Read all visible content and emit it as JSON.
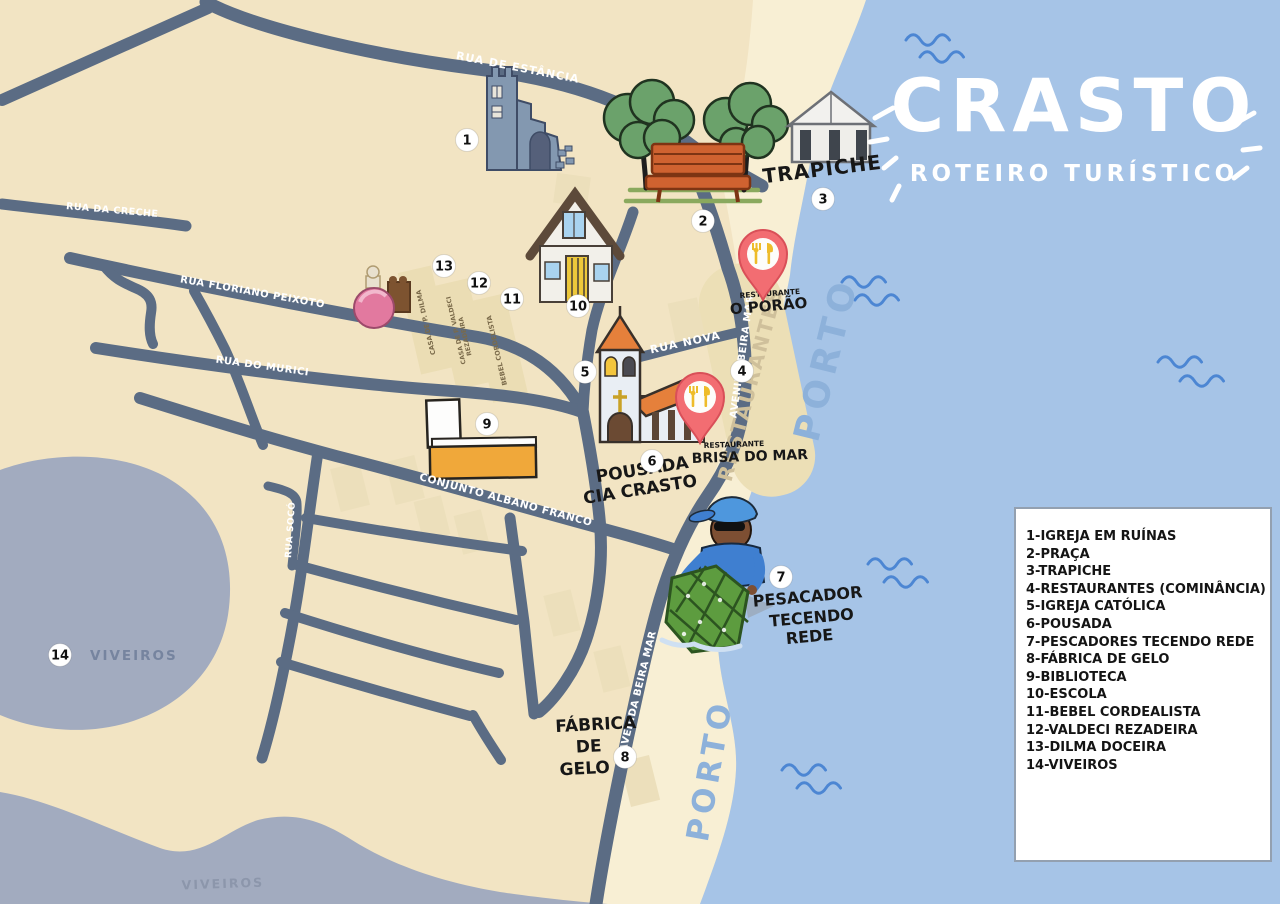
{
  "title": {
    "main": "CRASTO",
    "subtitle": "ROTEIRO TURÍSTICO"
  },
  "legend": {
    "items": [
      "1-IGREJA EM RUÍNAS",
      "2-PRAÇA",
      "3-TRAPICHE",
      "4-RESTAURANTES (COMINÂNCIA)",
      "5-IGREJA CATÓLICA",
      "6-POUSADA",
      "7-PESCADORES TECENDO REDE",
      "8-FÁBRICA DE GELO",
      "9-BIBLIOTECA",
      "10-ESCOLA",
      "11-BEBEL CORDEALISTA",
      "12-VALDECI REZADEIRA",
      "13-DILMA DOCEIRA",
      "14-VIVEIROS"
    ]
  },
  "streets": {
    "estancia": "RUA DE ESTÂNCIA",
    "creche": "RUA DA CRECHE",
    "floriano": "RUA FLORIANO PEIXOTO",
    "murici": "RUA DO MURICI",
    "nova": "RUA NOVA",
    "beira_mar": "AVENIDA BEIRA MAR",
    "conjunto": "CONJUNTO ALBANO FRANCO",
    "soco": "RUA SOCÓ"
  },
  "places": {
    "trapiche": "TRAPICHE",
    "restaurante_label": "RESTAURANTE",
    "porao": "O PORÃO",
    "brisa": "BRISA DO MAR",
    "pousada1": "POUSADA",
    "pousada2": "CIA CRASTO",
    "pescador1": "PESACADOR",
    "pescador2": "TECENDO",
    "pescador3": "REDE",
    "fabrica1": "FÁBRICA",
    "fabrica2": "DE",
    "fabrica3": "GELO",
    "viveiros": "VIVEIROS",
    "porto": "PORTO",
    "restaurantes_strip": "RESTAURANTES",
    "casa_dilma": "CASA DE P. DILMA",
    "casa_valdeci1": "CASA DE P. VALDECI",
    "casa_valdeci2": "REZADEIRA",
    "bebel": "BEBEL CORDELISTA"
  },
  "markers": [
    "1",
    "2",
    "3",
    "4",
    "5",
    "6",
    "7",
    "8",
    "9",
    "10",
    "11",
    "12",
    "13",
    "14"
  ],
  "colors": {
    "land": "#f2e4c3",
    "beach": "#f8efd4",
    "water": "#a6c4e7",
    "pond": "#a2abbf",
    "road": "#5b6c84",
    "pin_red": "#f26d72",
    "building_yellow": "#f0a83a",
    "roof_orange": "#e5803b",
    "tree_green": "#6ba26b"
  }
}
